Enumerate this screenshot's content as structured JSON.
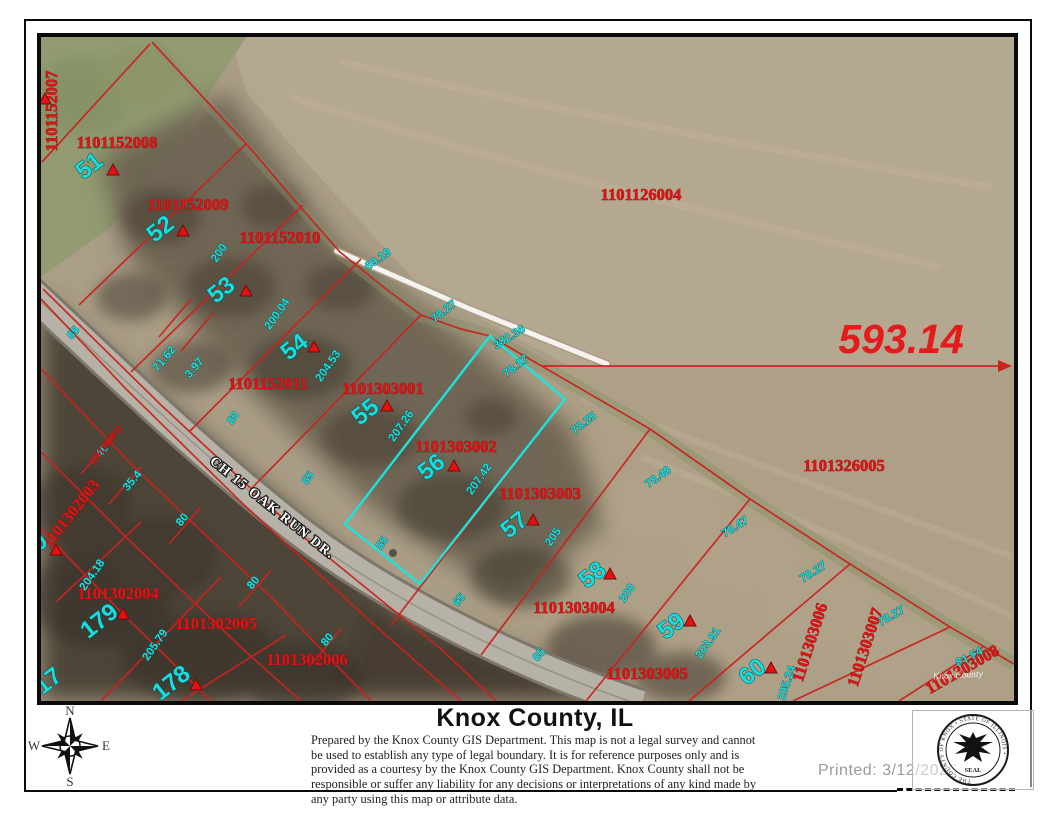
{
  "map": {
    "highlight_color": "#19e5dd",
    "parcel_line_color": "#c9231f",
    "parcel_id_color": "#e01414",
    "lot_number_color": "#17dede",
    "parcel_ids": [
      {
        "t": "1101152007",
        "x": 16,
        "y": 74,
        "r": -90
      },
      {
        "t": "1101152008",
        "x": 76,
        "y": 111,
        "r": 0
      },
      {
        "t": "1101152009",
        "x": 147,
        "y": 173,
        "r": 0
      },
      {
        "t": "1101152010",
        "x": 239,
        "y": 206,
        "r": 0
      },
      {
        "t": "1101126004",
        "x": 600,
        "y": 163,
        "r": 0
      },
      {
        "t": "1101152011",
        "x": 227,
        "y": 352,
        "r": 0
      },
      {
        "t": "1101303001",
        "x": 342,
        "y": 357,
        "r": 0
      },
      {
        "t": "1101303002",
        "x": 415,
        "y": 415,
        "r": 0
      },
      {
        "t": "1101303003",
        "x": 499,
        "y": 462,
        "r": 0
      },
      {
        "t": "1101326005",
        "x": 803,
        "y": 434,
        "r": 0
      },
      {
        "t": "1101302004",
        "x": 77,
        "y": 562,
        "r": 0
      },
      {
        "t": "1101302005",
        "x": 175,
        "y": 592,
        "r": 0
      },
      {
        "t": "1101302006",
        "x": 266,
        "y": 628,
        "r": 0
      },
      {
        "t": "1101303004",
        "x": 533,
        "y": 576,
        "r": 0
      },
      {
        "t": "1101303005",
        "x": 606,
        "y": 642,
        "r": 0
      },
      {
        "t": "1101303006",
        "x": 774,
        "y": 607,
        "r": -72
      },
      {
        "t": "1101303007",
        "x": 829,
        "y": 612,
        "r": -72
      },
      {
        "t": "1101303008",
        "x": 924,
        "y": 637,
        "r": -30
      },
      {
        "t": "1101302003",
        "x": 34,
        "y": 480,
        "r": -52
      },
      {
        "t": "1101302011",
        "x": 67,
        "y": 410,
        "r": -52,
        "small": true
      }
    ],
    "lot_numbers": [
      {
        "t": "51",
        "x": 53,
        "y": 135
      },
      {
        "t": "52",
        "x": 124,
        "y": 198
      },
      {
        "t": "53",
        "x": 185,
        "y": 259
      },
      {
        "t": "54",
        "x": 258,
        "y": 316
      },
      {
        "t": "55",
        "x": 329,
        "y": 381
      },
      {
        "t": "56",
        "x": 395,
        "y": 436
      },
      {
        "t": "57",
        "x": 478,
        "y": 494
      },
      {
        "t": "58",
        "x": 556,
        "y": 544
      },
      {
        "t": "59",
        "x": 635,
        "y": 595
      },
      {
        "t": "60",
        "x": 716,
        "y": 641
      },
      {
        "t": "178",
        "x": 135,
        "y": 652
      },
      {
        "t": "179",
        "x": 63,
        "y": 590
      },
      {
        "t": "17",
        "x": 12,
        "y": 650
      },
      {
        "t": "0",
        "x": 3,
        "y": 511
      }
    ],
    "dimension_labels": [
      {
        "t": "200",
        "x": 181,
        "y": 218,
        "r": -55
      },
      {
        "t": "200.04",
        "x": 239,
        "y": 279,
        "r": -55
      },
      {
        "t": "204.53",
        "x": 290,
        "y": 331,
        "r": -55
      },
      {
        "t": "71.62",
        "x": 126,
        "y": 324,
        "r": -50
      },
      {
        "t": "3.97",
        "x": 156,
        "y": 333,
        "r": -50
      },
      {
        "t": "207.26",
        "x": 363,
        "y": 391,
        "r": -55
      },
      {
        "t": "207.42",
        "x": 441,
        "y": 444,
        "r": -55
      },
      {
        "t": "205",
        "x": 515,
        "y": 502,
        "r": -55
      },
      {
        "t": "200",
        "x": 589,
        "y": 558,
        "r": -55
      },
      {
        "t": "203.91",
        "x": 670,
        "y": 608,
        "r": -55
      },
      {
        "t": "205.79",
        "x": 117,
        "y": 610,
        "r": -55
      },
      {
        "t": "204.18",
        "x": 54,
        "y": 540,
        "r": -55
      },
      {
        "t": "205.24",
        "x": 749,
        "y": 647,
        "r": -72
      },
      {
        "t": "69.19",
        "x": 339,
        "y": 225,
        "r": -35
      },
      {
        "t": "78.27",
        "x": 405,
        "y": 277,
        "r": -38
      },
      {
        "t": "382.36",
        "x": 470,
        "y": 303,
        "r": -32
      },
      {
        "t": "78.17",
        "x": 477,
        "y": 332,
        "r": -38
      },
      {
        "t": "78.25",
        "x": 545,
        "y": 389,
        "r": -38
      },
      {
        "t": "78.48",
        "x": 619,
        "y": 443,
        "r": -35
      },
      {
        "t": "78.47",
        "x": 696,
        "y": 493,
        "r": -32
      },
      {
        "t": "78.27",
        "x": 774,
        "y": 538,
        "r": -32
      },
      {
        "t": "78.27",
        "x": 852,
        "y": 582,
        "r": -30
      },
      {
        "t": "81.54",
        "x": 930,
        "y": 623,
        "r": -28
      },
      {
        "t": "40",
        "x": 64,
        "y": 416,
        "r": -50
      },
      {
        "t": "35.4",
        "x": 94,
        "y": 446,
        "r": -50
      },
      {
        "t": "80",
        "x": 195,
        "y": 383,
        "r": -55
      },
      {
        "t": "85",
        "x": 270,
        "y": 443,
        "r": -55
      },
      {
        "t": "80",
        "x": 144,
        "y": 485,
        "r": -50
      },
      {
        "t": "80",
        "x": 215,
        "y": 548,
        "r": -50
      },
      {
        "t": "80",
        "x": 289,
        "y": 605,
        "r": -50
      },
      {
        "t": "85",
        "x": 344,
        "y": 508,
        "r": -55
      },
      {
        "t": "65",
        "x": 421,
        "y": 565,
        "r": -50
      },
      {
        "t": "85",
        "x": 501,
        "y": 620,
        "r": -50
      },
      {
        "t": "85",
        "x": 35,
        "y": 298,
        "r": -50
      }
    ],
    "triangle_markers": [
      {
        "x": 72,
        "y": 133
      },
      {
        "x": 142,
        "y": 194
      },
      {
        "x": 205,
        "y": 254
      },
      {
        "x": 273,
        "y": 310
      },
      {
        "x": 346,
        "y": 369
      },
      {
        "x": 413,
        "y": 429
      },
      {
        "x": 492,
        "y": 483
      },
      {
        "x": 569,
        "y": 537
      },
      {
        "x": 649,
        "y": 584
      },
      {
        "x": 730,
        "y": 631
      },
      {
        "x": 82,
        "y": 577
      },
      {
        "x": 155,
        "y": 648
      },
      {
        "x": 15,
        "y": 513
      },
      {
        "x": 4,
        "y": 62
      }
    ],
    "big_measurement": {
      "t": "593.14",
      "x": 860,
      "y": 302
    },
    "road_label": {
      "t": "CH 15 OAK RUN DR.",
      "x": 229,
      "y": 474,
      "r": 38.5
    },
    "imagery_watermark": {
      "t": "Knox County",
      "x": 917,
      "y": 638,
      "r": -3
    }
  },
  "footer": {
    "compass": {
      "north": "N",
      "south": "S",
      "east": "E",
      "west": "W"
    },
    "title": "Knox County, IL",
    "disclaimer": "Prepared by the Knox County GIS Department. This map is not a legal survey and cannot be used to establish any type of legal boundary. It is for reference purposes only and is provided as a courtesy by the Knox County GIS Department.  Knox County shall not be responsible or suffer any liability for any decisions or interpretations of any kind made by any party using this map or attribute data.",
    "printed": "Printed: 3/12/2026",
    "seal": {
      "ring_text": "THE COUNTY OF KNOX • STATE OF ILLINOIS •",
      "bottom_text": "SEAL"
    }
  }
}
